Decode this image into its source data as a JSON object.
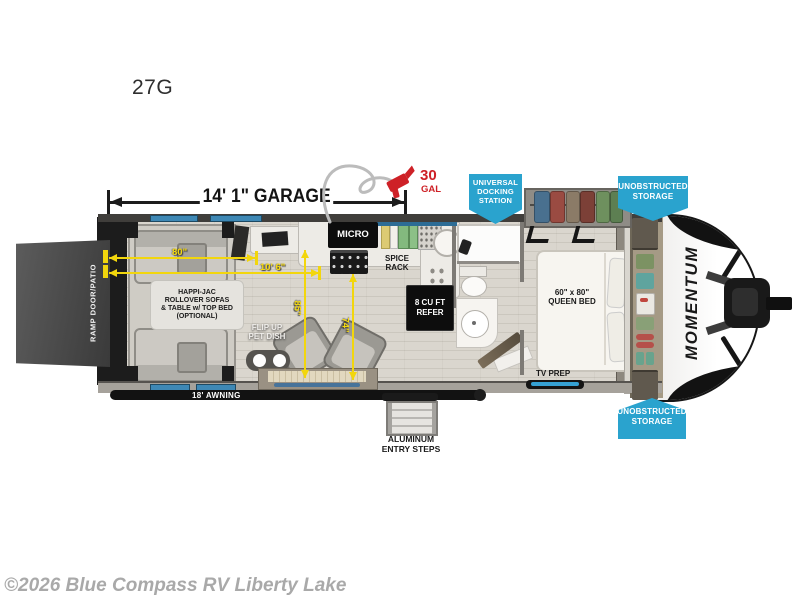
{
  "meta": {
    "model": "27G",
    "watermark": "©2026 Blue Compass RV Liberty Lake",
    "brand_logo": "MOMENTUM"
  },
  "colors": {
    "badge_blue": "#2aa3ce",
    "dimension_yellow": "#f2d60d",
    "fuel_red": "#ce2127"
  },
  "dimensions": {
    "garage_length": "14' 1\" GARAGE",
    "fuel_qty": "30",
    "fuel_unit": "GAL",
    "sofa_width": "80\"",
    "interior_width": "10' 6\"",
    "clearance_a": "85\"",
    "clearance_b": "74\"",
    "awning": "18' AWNING"
  },
  "badges": {
    "docking_station": {
      "line1": "UNIVERSAL",
      "line2": "DOCKING",
      "line3": "STATION"
    },
    "storage_top": {
      "line1": "UNOBSTRUCTED",
      "line2": "STORAGE"
    },
    "storage_bottom": {
      "line1": "UNOBSTRUCTED",
      "line2": "STORAGE"
    }
  },
  "labels": {
    "ramp_door": "RAMP DOOR/PATIO",
    "sofa_line1": "HAPPI-JAC",
    "sofa_line2": "ROLLOVER SOFAS",
    "sofa_line3": "& TABLE w/ TOP BED",
    "sofa_line4": "(OPTIONAL)",
    "pet_line1": "FLIP UP",
    "pet_line2": "PET DISH",
    "micro": "MICRO",
    "spice_line1": "SPICE",
    "spice_line2": "RACK",
    "refer_line1": "8 CU FT",
    "refer_line2": "REFER",
    "bed_line1": "60\" x 80\"",
    "bed_line2": "QUEEN BED",
    "tv_prep": "TV PREP",
    "steps_line1": "ALUMINUM",
    "steps_line2": "ENTRY STEPS"
  }
}
